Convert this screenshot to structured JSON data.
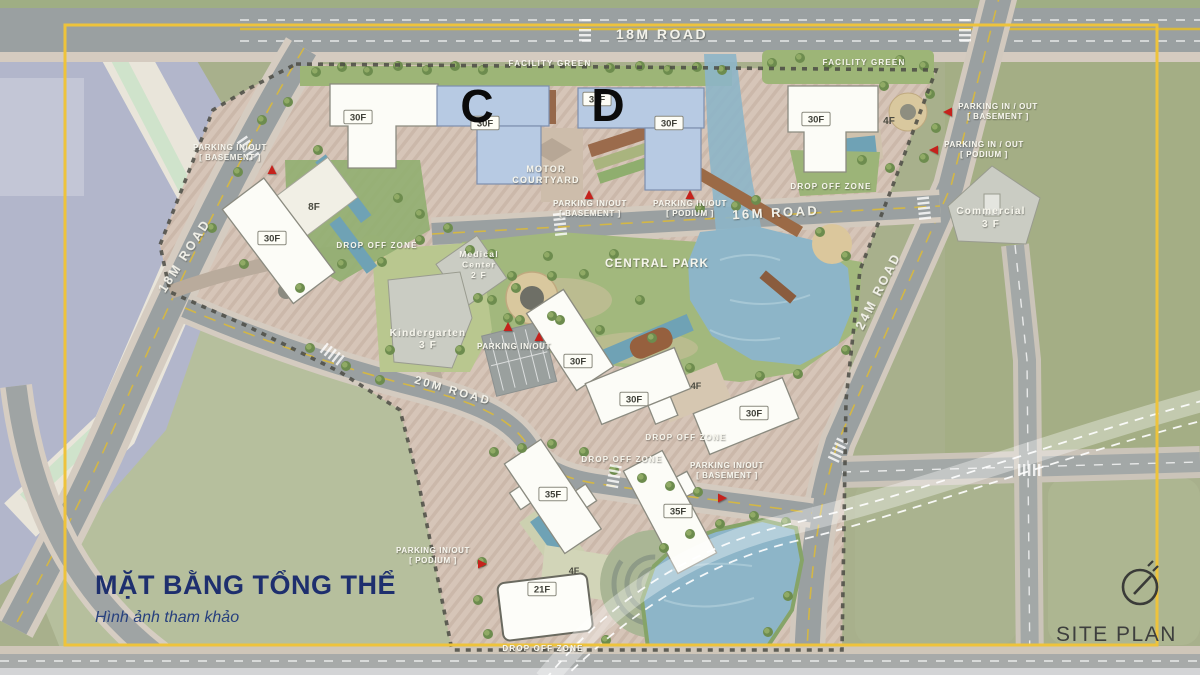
{
  "colors": {
    "frame_yellow": "#eec33b",
    "title_navy": "#1e2f6e",
    "highlight_building_blue": "#b7cae3",
    "arrow_red": "#c5231d",
    "water": "#8db5c8",
    "park_green": "#a2b87d"
  },
  "corner": {
    "label": "SITE PLAN"
  },
  "title_block": {
    "title": "MẶT BẰNG TỔNG THỂ",
    "subtitle": "Hình ảnh tham khảo"
  },
  "road_labels": [
    {
      "id": "road-18m-top",
      "label": "18M ROAD",
      "x": 662,
      "y": 39,
      "rotate": 0,
      "size": 14
    },
    {
      "id": "road-18m-left",
      "label": "18M ROAD",
      "x": 188,
      "y": 258,
      "rotate": -57,
      "size": 12.5
    },
    {
      "id": "road-16m",
      "label": "16M ROAD",
      "x": 776,
      "y": 217,
      "rotate": -3,
      "size": 13
    },
    {
      "id": "road-24m",
      "label": "24M ROAD",
      "x": 882,
      "y": 293,
      "rotate": -63,
      "size": 12.5
    },
    {
      "id": "road-20m",
      "label": "20M ROAD",
      "x": 452,
      "y": 394,
      "rotate": 16,
      "size": 11.5
    }
  ],
  "zone_labels": [
    {
      "id": "facility-green-west",
      "lines": [
        "FACILITY GREEN"
      ],
      "x": 550,
      "y": 66,
      "size": 8
    },
    {
      "id": "facility-green-east",
      "lines": [
        "FACILITY GREEN"
      ],
      "x": 864,
      "y": 65,
      "size": 8
    },
    {
      "id": "motor-courtyard",
      "lines": [
        "MOTOR",
        "COURTYARD"
      ],
      "x": 546,
      "y": 172,
      "size": 9
    },
    {
      "id": "central-park",
      "lines": [
        "CENTRAL PARK"
      ],
      "x": 657,
      "y": 267,
      "size": 11.5
    },
    {
      "id": "drop-off-nw",
      "lines": [
        "DROP OFF ZONE"
      ],
      "x": 377,
      "y": 248,
      "size": 8
    },
    {
      "id": "drop-off-ne",
      "lines": [
        "DROP OFF ZONE"
      ],
      "x": 831,
      "y": 189,
      "size": 8
    },
    {
      "id": "drop-off-mid-east",
      "lines": [
        "DROP OFF ZONE"
      ],
      "x": 686,
      "y": 440,
      "size": 8
    },
    {
      "id": "drop-off-mid-west",
      "lines": [
        "DROP OFF ZONE"
      ],
      "x": 622,
      "y": 462,
      "size": 8
    },
    {
      "id": "drop-off-south",
      "lines": [
        "DROP OFF ZONE"
      ],
      "x": 543,
      "y": 651,
      "size": 8
    }
  ],
  "parking_labels": [
    {
      "id": "parking-nw",
      "lines": [
        "PARKING  IN/OUT",
        "[ BASEMENT ]"
      ],
      "x": 230,
      "y": 150,
      "arrows": [
        {
          "x": 272,
          "y": 170,
          "dir": "up"
        }
      ]
    },
    {
      "id": "parking-motor-basement",
      "lines": [
        "PARKING  IN/OUT",
        "[ BASEMENT ]"
      ],
      "x": 590,
      "y": 206,
      "arrows": [
        {
          "x": 589,
          "y": 195,
          "dir": "up"
        }
      ]
    },
    {
      "id": "parking-motor-podium",
      "lines": [
        "PARKING  IN/OUT",
        "[ PODIUM ]"
      ],
      "x": 690,
      "y": 206,
      "arrows": [
        {
          "x": 690,
          "y": 195,
          "dir": "up"
        }
      ]
    },
    {
      "id": "parking-ne-basement",
      "lines": [
        "PARKING  IN / OUT",
        "[ BASEMENT ]"
      ],
      "x": 998,
      "y": 109,
      "arrows": [
        {
          "x": 948,
          "y": 112,
          "dir": "left"
        }
      ]
    },
    {
      "id": "parking-ne-podium",
      "lines": [
        "PARKING  IN / OUT",
        "[ PODIUM ]"
      ],
      "x": 984,
      "y": 147,
      "arrows": [
        {
          "x": 934,
          "y": 150,
          "dir": "left"
        }
      ]
    },
    {
      "id": "parking-center",
      "lines": [
        "PARKING  IN/OUT"
      ],
      "x": 514,
      "y": 349,
      "arrows": [
        {
          "x": 508,
          "y": 327,
          "dir": "up"
        },
        {
          "x": 539,
          "y": 337,
          "dir": "up"
        }
      ]
    },
    {
      "id": "parking-south-basement",
      "lines": [
        "PARKING  IN/OUT",
        "[ BASEMENT ]"
      ],
      "x": 727,
      "y": 468,
      "arrows": [
        {
          "x": 722,
          "y": 498,
          "dir": "right"
        }
      ]
    },
    {
      "id": "parking-south-podium",
      "lines": [
        "PARKING  IN/OUT",
        "[ PODIUM ]"
      ],
      "x": 433,
      "y": 553,
      "arrows": [
        {
          "x": 482,
          "y": 564,
          "dir": "right"
        }
      ]
    }
  ],
  "tower_letters": [
    {
      "id": "block-c",
      "label": "C",
      "x": 477,
      "y": 122
    },
    {
      "id": "block-d",
      "label": "D",
      "x": 608,
      "y": 121
    }
  ],
  "floor_tags": [
    {
      "label": "30F",
      "x": 358,
      "y": 117
    },
    {
      "label": "30F",
      "x": 272,
      "y": 238
    },
    {
      "label": "30F",
      "x": 485,
      "y": 123
    },
    {
      "label": "30F",
      "x": 597,
      "y": 99
    },
    {
      "label": "30F",
      "x": 669,
      "y": 123
    },
    {
      "label": "30F",
      "x": 816,
      "y": 119
    },
    {
      "label": "30F",
      "x": 578,
      "y": 361
    },
    {
      "label": "30F",
      "x": 634,
      "y": 399
    },
    {
      "label": "30F",
      "x": 754,
      "y": 413
    },
    {
      "label": "35F",
      "x": 553,
      "y": 494
    },
    {
      "label": "35F",
      "x": 678,
      "y": 511
    },
    {
      "label": "21F",
      "x": 542,
      "y": 589
    }
  ],
  "floor_texts": [
    {
      "label": "8F",
      "x": 314,
      "y": 210,
      "size": 10
    },
    {
      "label": "4F",
      "x": 889,
      "y": 124,
      "size": 10
    },
    {
      "label": "4F",
      "x": 696,
      "y": 389,
      "size": 9
    },
    {
      "label": "4F",
      "x": 574,
      "y": 574,
      "size": 9
    }
  ],
  "facility_texts": [
    {
      "id": "medical-center",
      "lines": [
        "Medical",
        "Center",
        "2 F"
      ],
      "x": 479,
      "y": 257,
      "lh": 10.5,
      "size": 8.5,
      "color": "#f2f1e8"
    },
    {
      "id": "kindergarten",
      "lines": [
        "Kindergarten",
        "3 F"
      ],
      "x": 428,
      "y": 336,
      "lh": 12,
      "size": 10,
      "color": "#f2f1e8"
    },
    {
      "id": "commercial",
      "lines": [
        "Commercial",
        "3 F"
      ],
      "x": 991,
      "y": 214,
      "lh": 13,
      "size": 10,
      "color": "#8e9086"
    }
  ]
}
